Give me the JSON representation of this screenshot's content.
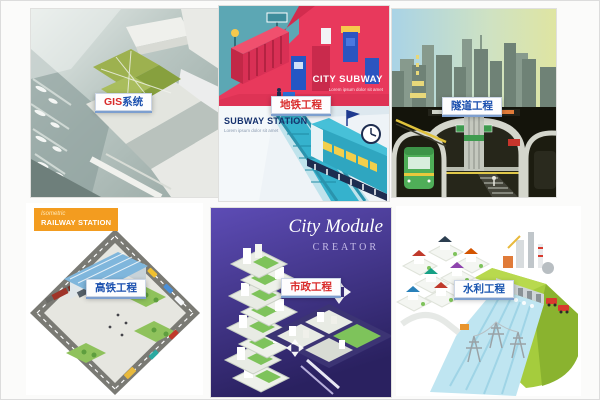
{
  "colors": {
    "tag_red": "#d92b2b",
    "tag_blue": "#1a4fae",
    "subway_red": "#e8395c",
    "subway_teal": "#5ca7b4",
    "module_purple": "#3a2d7d",
    "badge_orange": "#f39c1f",
    "hill_green": "#a5cc3d"
  },
  "tiles": [
    {
      "name": "gis-system",
      "tag": {
        "prefix": "GIS",
        "suffix": "系统",
        "prefix_color": "#d92b2b",
        "suffix_color": "#1a4fae"
      }
    },
    {
      "name": "subway-engineering",
      "banner_title": "CITY SUBWAY",
      "banner_subtitle": "Lorem ipsum dolor sit amet",
      "station_title": "SUBWAY STATION",
      "station_subtitle": "Lorem ipsum dolor sit amet",
      "tag": {
        "label": "地铁工程",
        "color": "#d92b2b"
      }
    },
    {
      "name": "tunnel-engineering",
      "tag": {
        "label": "隧道工程",
        "color": "#1a4fae"
      }
    },
    {
      "name": "high-speed-rail-engineering",
      "badge": {
        "line1": "Isometric",
        "line2": "RAILWAY STATION",
        "bg": "#f39c1f"
      },
      "tag": {
        "label": "高铁工程",
        "color": "#1a4fae"
      }
    },
    {
      "name": "municipal-engineering",
      "poster_title": "City Module",
      "poster_subtitle": "CREATOR",
      "tag": {
        "label": "市政工程",
        "color": "#d92b2b"
      }
    },
    {
      "name": "water-conservancy-engineering",
      "tag": {
        "label": "水利工程",
        "color": "#1a56b0"
      }
    }
  ]
}
